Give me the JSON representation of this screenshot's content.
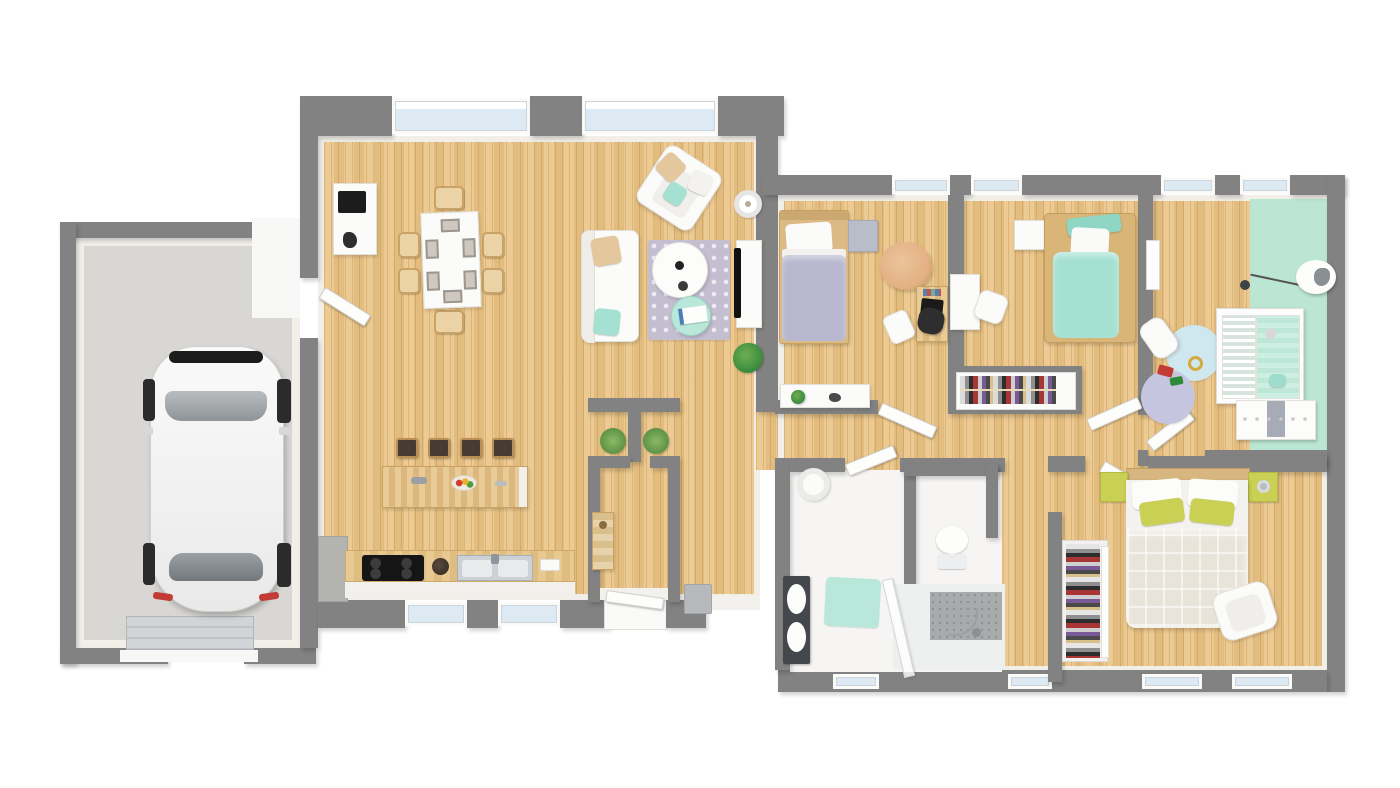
{
  "canvas": {
    "width": 1400,
    "height": 788
  },
  "palette": {
    "wall": "#828282",
    "innerWall": "#f2efe9",
    "woodA": "#ecca92",
    "woodB": "#e3bd7f",
    "garageFloor": "#d8d7d4",
    "whiteFloor": "#f6f5f3",
    "glass": "#dde9f3",
    "mint": "#bce6d4",
    "mintBed": "#a5e1d3",
    "mintMat": "#b9e8da",
    "lavender": "#c5c5df",
    "lavBed": "#b7b8d0",
    "blueRug": "#cfe7ef",
    "green": "#c9d054",
    "beige": "#e5c79e",
    "tan": "#e3b184",
    "rugBase": "#c3bed0",
    "rugDot": "#edeaf2",
    "dark": "#1d1d1d",
    "counter": "#44484c",
    "red": "#c23b35",
    "plant": "#3f8f3f"
  },
  "scene": {
    "type": "3d-rendered-floor-plan-top-view",
    "text_labels": [],
    "rooms": [
      {
        "id": "garage",
        "floor": "concrete-gray",
        "contents": [
          "white-car",
          "sectional-garage-door"
        ]
      },
      {
        "id": "living-dining-room",
        "floor": "light-wood",
        "contents": [
          "sideboard-with-microwave",
          "dining-table",
          "six-dining-chairs",
          "six-placemats",
          "sofa-white",
          "armchair-white",
          "patterned-rug",
          "round-coffee-table",
          "mint-side-table",
          "tv-stand",
          "flat-tv",
          "floor-lamp",
          "potted-plant"
        ]
      },
      {
        "id": "kitchen",
        "floor": "light-wood",
        "contents": [
          "island-counter",
          "four-bar-stools",
          "fruit-bowl",
          "cooktop-4-burners",
          "double-sink",
          "gray-corner-counter"
        ]
      },
      {
        "id": "entry-hall",
        "floor": "light-wood",
        "contents": [
          "front-door",
          "shoe-cabinet",
          "two-grass-plants",
          "radiator-box"
        ]
      },
      {
        "id": "bedroom-1",
        "floor": "light-wood",
        "contents": [
          "single-bed-lavender",
          "gray-nightstand",
          "bean-bag-tan",
          "desk-with-laptop",
          "black-desk-chair",
          "white-chair",
          "low-white-shelf-with-plant"
        ]
      },
      {
        "id": "bedroom-2",
        "floor": "light-wood",
        "contents": [
          "single-bed-mint",
          "white-desk",
          "white-chair",
          "white-cabinet",
          "open-closet-with-clothes"
        ]
      },
      {
        "id": "nursery",
        "floor": "light-wood-and-mint",
        "contents": [
          "crib-white",
          "changing-dresser",
          "pendant-lamp",
          "blue-round-rug",
          "lavender-round-rug",
          "white-chair",
          "toys",
          "wall-frame"
        ]
      },
      {
        "id": "bathroom",
        "floor": "white-tile",
        "contents": [
          "double-sink-vanity",
          "walk-in-shower-glass",
          "mint-bath-mat",
          "laundry-basket"
        ]
      },
      {
        "id": "wc",
        "floor": "white-tile",
        "contents": [
          "toilet"
        ]
      },
      {
        "id": "master-bedroom",
        "floor": "light-wood",
        "contents": [
          "double-bed-white-duvet",
          "green-accent-pillows",
          "two-green-nightstands",
          "bedside-lamp",
          "white-armchair",
          "built-in-wardrobe-with-clothes"
        ]
      },
      {
        "id": "hallway",
        "floor": "light-wood",
        "contents": [
          "five-open-door-leaves"
        ]
      }
    ],
    "vehicle": {
      "type": "hatchback-car",
      "color": "white",
      "location": "garage"
    }
  }
}
